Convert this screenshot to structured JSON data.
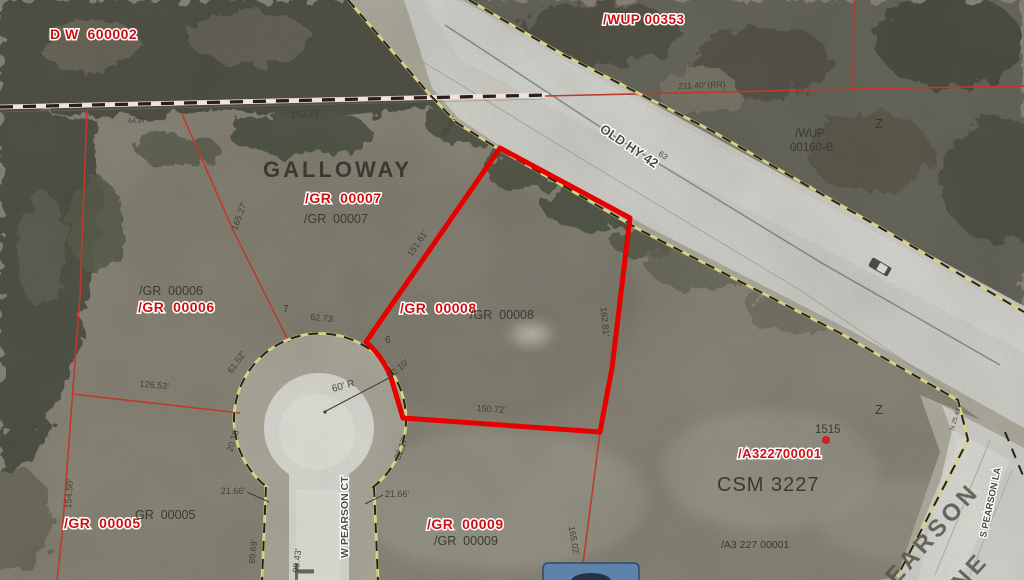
{
  "labels": {
    "subdivision": "GALLOWAY",
    "dw600002": "D W  600002",
    "wup00353": "/WUP 00353",
    "wup00160_line1": "/WUP",
    "wup00160_line2": "00160-B",
    "gr00007_red": "/GR  00007",
    "gr00007_gray": "/GR  00007",
    "gr00006_red": "/GR  00006",
    "gr00006_gray": "/GR  00006",
    "gr00008_red": "/GR  00008",
    "gr00008_gray": "/GR  00008",
    "gr00005_red": "/GR  00005",
    "gr00005_gray": "GR  00005",
    "gr00009_red": "/GR  00009",
    "gr00009_gray": "/GR  00009",
    "a322700001_red": "/A322700001",
    "a322700001_gray": "/A3 227 00001",
    "csm3227": "CSM 3227",
    "address_1515": "1515",
    "lot7": "7",
    "lot6": "6",
    "z_marker_1": "Z",
    "z_marker_2": "Z"
  },
  "streets": {
    "old_hy_42": "OLD HY 42",
    "mile_63": "63",
    "w_pearson_ct": "W PEARSON CT",
    "s_pearson_la": "S PEARSON LA",
    "street_big_t": "T",
    "street_big_pearson": "EARSON",
    "street_big_lane_ne": "NE"
  },
  "dimensions": {
    "rr_15321": "153.21'",
    "rr_6457": "64.57",
    "rr_21140": "211.40' (RR)",
    "hwy_6966": "69.66'",
    "p8_west_15161": "151.61'",
    "p8_east_16281": "162.81'",
    "p8_south_15072": "150.72'",
    "p9_east_16502": "165.02'",
    "p7_west_16527": "165.27'",
    "p5_west_15450": "154.50'",
    "p6_south_12653": "126.53'",
    "cul_6152": "61.52'",
    "cul_6273": "62.73'",
    "cul_6210": "62.10'",
    "cul_8217": "82.17'",
    "cul_2015": "20.15'",
    "cul_2166_left": "21.66'",
    "cul_2166_right": "21.66'",
    "ct_8969": "89.69'",
    "ct_9943": "99.43'",
    "radius_60r": "60' R",
    "bearing_n2543": "N 25 43"
  },
  "colors": {
    "highlight": "#e80000",
    "parcel_line": "#c0392b",
    "label_red": "#cc1111",
    "address_dot": "#cc2222"
  }
}
